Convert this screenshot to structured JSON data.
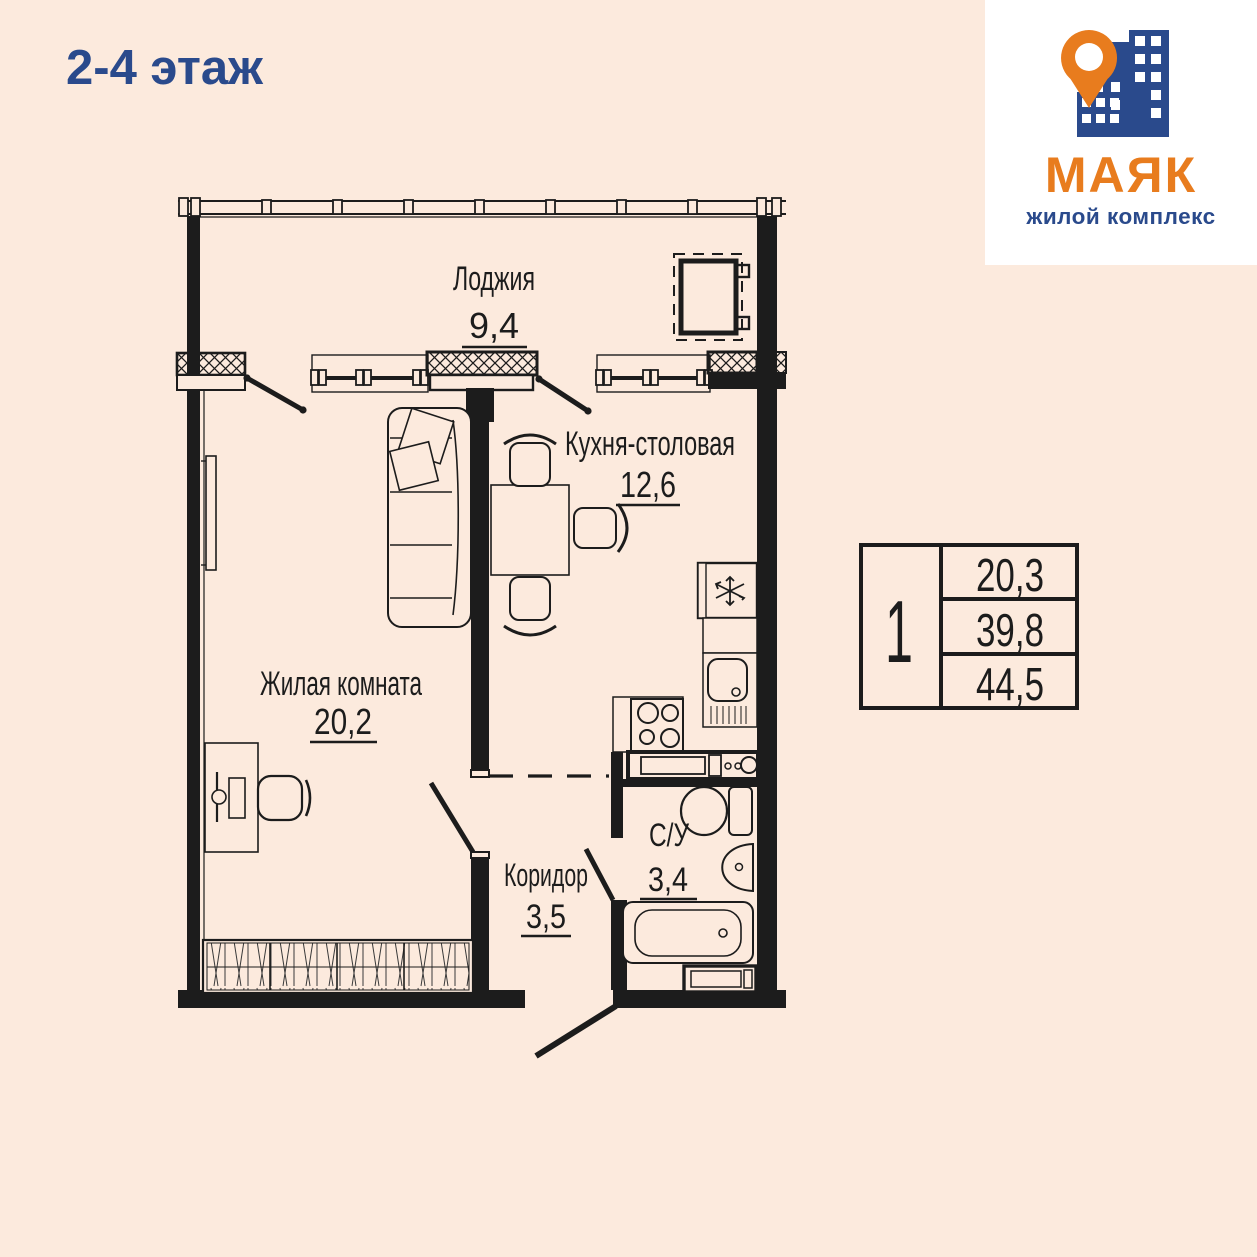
{
  "header": {
    "title": "2-4 этаж"
  },
  "logo": {
    "brand": "МАЯК",
    "subtitle": "жилой комплекс",
    "icon": "building-with-location-pin-icon",
    "colors": {
      "orange": "#e87c1e",
      "blue": "#2a4a8c"
    }
  },
  "plan": {
    "rooms": [
      {
        "name": "Лоджия",
        "area": "9,4"
      },
      {
        "name": "Кухня-столовая",
        "area": "12,6"
      },
      {
        "name": "Жилая комната",
        "area": "20,2"
      },
      {
        "name": "Коридор",
        "area": "3,5"
      },
      {
        "name": "С/У",
        "area": "3,4"
      }
    ],
    "icons": {
      "fridge": "snowflake-icon",
      "stove": "four-burner-stove-icon",
      "sink": "kitchen-sink-icon",
      "bath": "bathtub-icon",
      "toilet": "toilet-icon"
    }
  },
  "info_table": {
    "rooms_count": "1",
    "values": [
      "20,3",
      "39,8",
      "44,5"
    ]
  },
  "colors": {
    "background": "#fceadd",
    "line": "#1c1c1c",
    "accent_blue": "#2a4a8c",
    "accent_orange": "#e87c1e"
  }
}
